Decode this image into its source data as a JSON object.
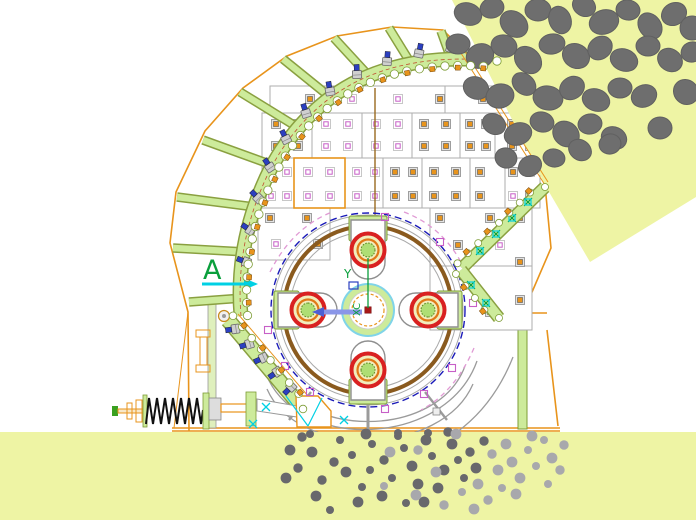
{
  "title": "hammer-crusher-section-cad-drawing",
  "labels": {
    "section_marker": "A",
    "axis_y": "Y",
    "axis_x": "XC"
  },
  "colors": {
    "orange": "#e8941c",
    "olive": "#7d9c35",
    "lgreen": "#cdeb9b",
    "lgreen2": "#dff0bd",
    "brown": "#8a5a1e",
    "blue": "#1a1ab8",
    "boltblue": "#2b3fc0",
    "red": "#d92121",
    "oring": "#e07818",
    "magenta": "#c75fc7",
    "pinkarc": "#e09ad4",
    "cyan": "#00d0e4",
    "gtext": "#0a9f3c",
    "peri": "#8a96e8",
    "gray": "#9b9b9b",
    "rock": "#6e6e6e",
    "pdark": "#68686c",
    "plight": "#a8a8ac",
    "yellow": "#eef4a4",
    "cline": "#9a6a20"
  },
  "scene": {
    "rotor": {
      "cx": 368,
      "cy": 310,
      "hammer_angles": [
        0,
        90,
        180,
        270
      ]
    },
    "ribs": [
      [
        243,
        298,
        189,
        302
      ],
      [
        246,
        252,
        173,
        248
      ],
      [
        255,
        207,
        177,
        197
      ],
      [
        272,
        165,
        203,
        140
      ],
      [
        297,
        127,
        240,
        92
      ],
      [
        330,
        97,
        283,
        59
      ],
      [
        369,
        76,
        334,
        38
      ],
      [
        410,
        62,
        389,
        28
      ],
      [
        450,
        56,
        441,
        31
      ]
    ],
    "bolts": [
      [
        246,
        262
      ],
      [
        250,
        230
      ],
      [
        258,
        198
      ],
      [
        270,
        167
      ],
      [
        286,
        139
      ],
      [
        306,
        113
      ],
      [
        330,
        91
      ],
      [
        357,
        74
      ],
      [
        387,
        61
      ],
      [
        419,
        53
      ],
      [
        451,
        48
      ],
      [
        235,
        329
      ],
      [
        249,
        344
      ],
      [
        263,
        358
      ],
      [
        277,
        372
      ],
      [
        291,
        387
      ]
    ],
    "cyan_bolts": [
      [
        480,
        251
      ],
      [
        496,
        234
      ],
      [
        512,
        218
      ],
      [
        528,
        202
      ],
      [
        471,
        285
      ],
      [
        486,
        303
      ]
    ],
    "pink_squares": [
      [
        385,
        217
      ],
      [
        440,
        242
      ],
      [
        268,
        330
      ],
      [
        285,
        366
      ],
      [
        310,
        392
      ],
      [
        385,
        409
      ],
      [
        424,
        394
      ],
      [
        452,
        368
      ],
      [
        473,
        303
      ]
    ],
    "cyan_crosses": [
      [
        253,
        424
      ],
      [
        266,
        407
      ],
      [
        344,
        420
      ]
    ],
    "markers": [
      [
        310,
        99,
        "B"
      ],
      [
        352,
        99,
        "A"
      ],
      [
        398,
        99,
        "A"
      ],
      [
        440,
        99,
        "B"
      ],
      [
        483,
        99,
        "B"
      ],
      [
        528,
        99,
        "B"
      ],
      [
        276,
        124,
        "B"
      ],
      [
        298,
        124,
        "B"
      ],
      [
        276,
        146,
        "B"
      ],
      [
        298,
        146,
        "B"
      ],
      [
        326,
        124,
        "A"
      ],
      [
        348,
        124,
        "A"
      ],
      [
        326,
        146,
        "A"
      ],
      [
        348,
        146,
        "A"
      ],
      [
        376,
        124,
        "A"
      ],
      [
        398,
        124,
        "A"
      ],
      [
        376,
        146,
        "A"
      ],
      [
        398,
        146,
        "A"
      ],
      [
        424,
        124,
        "B"
      ],
      [
        446,
        124,
        "B"
      ],
      [
        424,
        146,
        "B"
      ],
      [
        446,
        146,
        "B"
      ],
      [
        470,
        124,
        "B"
      ],
      [
        486,
        124,
        "B"
      ],
      [
        470,
        146,
        "B"
      ],
      [
        486,
        146,
        "B"
      ],
      [
        512,
        124,
        "B"
      ],
      [
        530,
        124,
        "B"
      ],
      [
        512,
        146,
        "B"
      ],
      [
        530,
        146,
        "B"
      ],
      [
        271,
        172,
        "A"
      ],
      [
        287,
        172,
        "A"
      ],
      [
        271,
        196,
        "A"
      ],
      [
        287,
        196,
        "A"
      ],
      [
        308,
        172,
        "A"
      ],
      [
        330,
        172,
        "A"
      ],
      [
        308,
        196,
        "A"
      ],
      [
        330,
        196,
        "A"
      ],
      [
        357,
        172,
        "A"
      ],
      [
        375,
        172,
        "A"
      ],
      [
        357,
        196,
        "A"
      ],
      [
        375,
        196,
        "A"
      ],
      [
        395,
        172,
        "B"
      ],
      [
        413,
        172,
        "B"
      ],
      [
        395,
        196,
        "B"
      ],
      [
        413,
        196,
        "B"
      ],
      [
        434,
        172,
        "B"
      ],
      [
        456,
        172,
        "B"
      ],
      [
        434,
        196,
        "B"
      ],
      [
        456,
        196,
        "B"
      ],
      [
        480,
        172,
        "B"
      ],
      [
        480,
        196,
        "B"
      ],
      [
        513,
        172,
        "B"
      ],
      [
        513,
        196,
        "A"
      ],
      [
        530,
        172,
        "A"
      ],
      [
        530,
        196,
        "B"
      ],
      [
        270,
        218,
        "B"
      ],
      [
        307,
        218,
        "B"
      ],
      [
        276,
        244,
        "A"
      ],
      [
        318,
        244,
        "B"
      ],
      [
        440,
        218,
        "B"
      ],
      [
        490,
        218,
        "B"
      ],
      [
        520,
        218,
        "B"
      ],
      [
        458,
        245,
        "B"
      ],
      [
        500,
        245,
        "A"
      ],
      [
        520,
        262,
        "B"
      ],
      [
        447,
        300,
        "B"
      ],
      [
        490,
        312,
        "B"
      ],
      [
        520,
        300,
        "B"
      ]
    ],
    "rocks": [
      [
        468,
        14,
        14,
        11,
        20
      ],
      [
        492,
        8,
        12,
        10,
        -15
      ],
      [
        514,
        24,
        15,
        12,
        40
      ],
      [
        538,
        10,
        13,
        11,
        0
      ],
      [
        560,
        20,
        14,
        11,
        70
      ],
      [
        584,
        6,
        12,
        10,
        30
      ],
      [
        604,
        22,
        15,
        12,
        -20
      ],
      [
        628,
        10,
        12,
        10,
        10
      ],
      [
        650,
        26,
        14,
        11,
        55
      ],
      [
        674,
        14,
        13,
        11,
        -30
      ],
      [
        692,
        28,
        12,
        12,
        0
      ],
      [
        458,
        44,
        12,
        10,
        0
      ],
      [
        480,
        56,
        14,
        12,
        -25
      ],
      [
        504,
        46,
        13,
        11,
        15
      ],
      [
        528,
        60,
        15,
        12,
        45
      ],
      [
        552,
        44,
        13,
        10,
        -10
      ],
      [
        576,
        56,
        14,
        12,
        30
      ],
      [
        600,
        48,
        13,
        11,
        -40
      ],
      [
        624,
        60,
        14,
        11,
        20
      ],
      [
        648,
        46,
        12,
        10,
        0
      ],
      [
        670,
        60,
        13,
        11,
        35
      ],
      [
        692,
        52,
        11,
        10,
        -20
      ],
      [
        476,
        88,
        13,
        11,
        25
      ],
      [
        500,
        96,
        14,
        12,
        -15
      ],
      [
        524,
        84,
        13,
        10,
        40
      ],
      [
        548,
        98,
        15,
        12,
        10
      ],
      [
        572,
        88,
        13,
        11,
        -35
      ],
      [
        596,
        100,
        14,
        11,
        20
      ],
      [
        620,
        88,
        12,
        10,
        0
      ],
      [
        644,
        96,
        13,
        11,
        -25
      ],
      [
        686,
        92,
        13,
        12,
        45
      ],
      [
        494,
        124,
        12,
        10,
        30
      ],
      [
        518,
        134,
        14,
        11,
        -20
      ],
      [
        542,
        122,
        12,
        10,
        15
      ],
      [
        566,
        134,
        14,
        12,
        40
      ],
      [
        590,
        124,
        12,
        10,
        -10
      ],
      [
        614,
        138,
        13,
        11,
        25
      ],
      [
        660,
        128,
        12,
        11,
        0
      ],
      [
        506,
        158,
        11,
        10,
        20
      ],
      [
        530,
        166,
        12,
        10,
        -30
      ],
      [
        554,
        158,
        11,
        9,
        10
      ],
      [
        580,
        150,
        12,
        10,
        35
      ],
      [
        610,
        144,
        11,
        10,
        -15
      ]
    ],
    "particles": [
      [
        302,
        437,
        0
      ],
      [
        312,
        452,
        0
      ],
      [
        298,
        468,
        0
      ],
      [
        322,
        480,
        0
      ],
      [
        334,
        462,
        0
      ],
      [
        316,
        496,
        0
      ],
      [
        340,
        440,
        0
      ],
      [
        352,
        455,
        0
      ],
      [
        346,
        472,
        0
      ],
      [
        362,
        487,
        0
      ],
      [
        330,
        510,
        0
      ],
      [
        372,
        444,
        0
      ],
      [
        384,
        460,
        0
      ],
      [
        370,
        470,
        0
      ],
      [
        392,
        478,
        0
      ],
      [
        358,
        502,
        0
      ],
      [
        404,
        448,
        0
      ],
      [
        398,
        436,
        0
      ],
      [
        412,
        466,
        0
      ],
      [
        418,
        484,
        0
      ],
      [
        382,
        496,
        0
      ],
      [
        406,
        503,
        0
      ],
      [
        426,
        440,
        0
      ],
      [
        432,
        456,
        0
      ],
      [
        444,
        470,
        0
      ],
      [
        438,
        488,
        0
      ],
      [
        424,
        502,
        0
      ],
      [
        452,
        444,
        0
      ],
      [
        458,
        460,
        0
      ],
      [
        464,
        478,
        0
      ],
      [
        470,
        452,
        0
      ],
      [
        476,
        468,
        0
      ],
      [
        484,
        441,
        0
      ],
      [
        448,
        432,
        0
      ],
      [
        310,
        434,
        0
      ],
      [
        366,
        434,
        0
      ],
      [
        398,
        433,
        0
      ],
      [
        428,
        433,
        0
      ],
      [
        290,
        450,
        0
      ],
      [
        286,
        478,
        0
      ],
      [
        390,
        452,
        1
      ],
      [
        418,
        450,
        1
      ],
      [
        436,
        472,
        1
      ],
      [
        462,
        492,
        1
      ],
      [
        478,
        484,
        1
      ],
      [
        492,
        454,
        1
      ],
      [
        498,
        470,
        1
      ],
      [
        506,
        444,
        1
      ],
      [
        512,
        462,
        1
      ],
      [
        520,
        478,
        1
      ],
      [
        528,
        450,
        1
      ],
      [
        536,
        466,
        1
      ],
      [
        544,
        440,
        1
      ],
      [
        552,
        458,
        1
      ],
      [
        560,
        470,
        1
      ],
      [
        502,
        488,
        1
      ],
      [
        488,
        500,
        1
      ],
      [
        516,
        494,
        1
      ],
      [
        548,
        484,
        1
      ],
      [
        416,
        495,
        1
      ],
      [
        444,
        505,
        1
      ],
      [
        474,
        509,
        1
      ],
      [
        564,
        445,
        1
      ],
      [
        384,
        486,
        1
      ],
      [
        456,
        434,
        1
      ],
      [
        532,
        436,
        1
      ]
    ]
  }
}
